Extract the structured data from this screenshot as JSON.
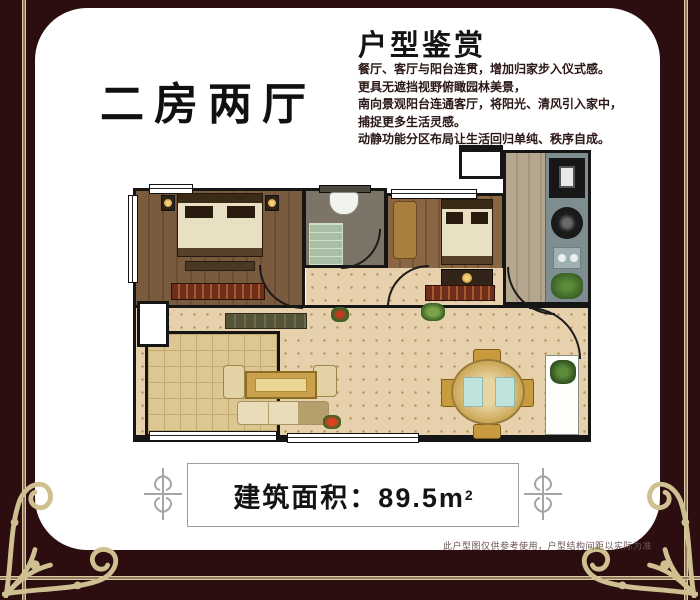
{
  "panel": {
    "plan_type_title": "二房两厅",
    "section_title": "户型鉴赏",
    "description_lines": [
      "餐厅、客厅与阳台连贯，增加归家步入仪式感。",
      "更具无遮挡视野俯瞰园林美景，",
      "南向景观阳台连通客厅，将阳光、清风引入家中，",
      "捕捉更多生活灵感。",
      "动静功能分区布局让生活回归单纯、秩序自成。"
    ],
    "area_banner": {
      "label": "建筑面积：89.5m",
      "superscript": "2"
    },
    "disclaimer": "此户型图仅供参考使用，户型结构间距以实际为准"
  },
  "colors": {
    "frame_maroon": "#2d0e10",
    "frame_gold": "#d9cca1",
    "panel_white": "#ffffff",
    "floor_beige": "#e6d1ac",
    "floor_wood": "#7b5b3e"
  }
}
